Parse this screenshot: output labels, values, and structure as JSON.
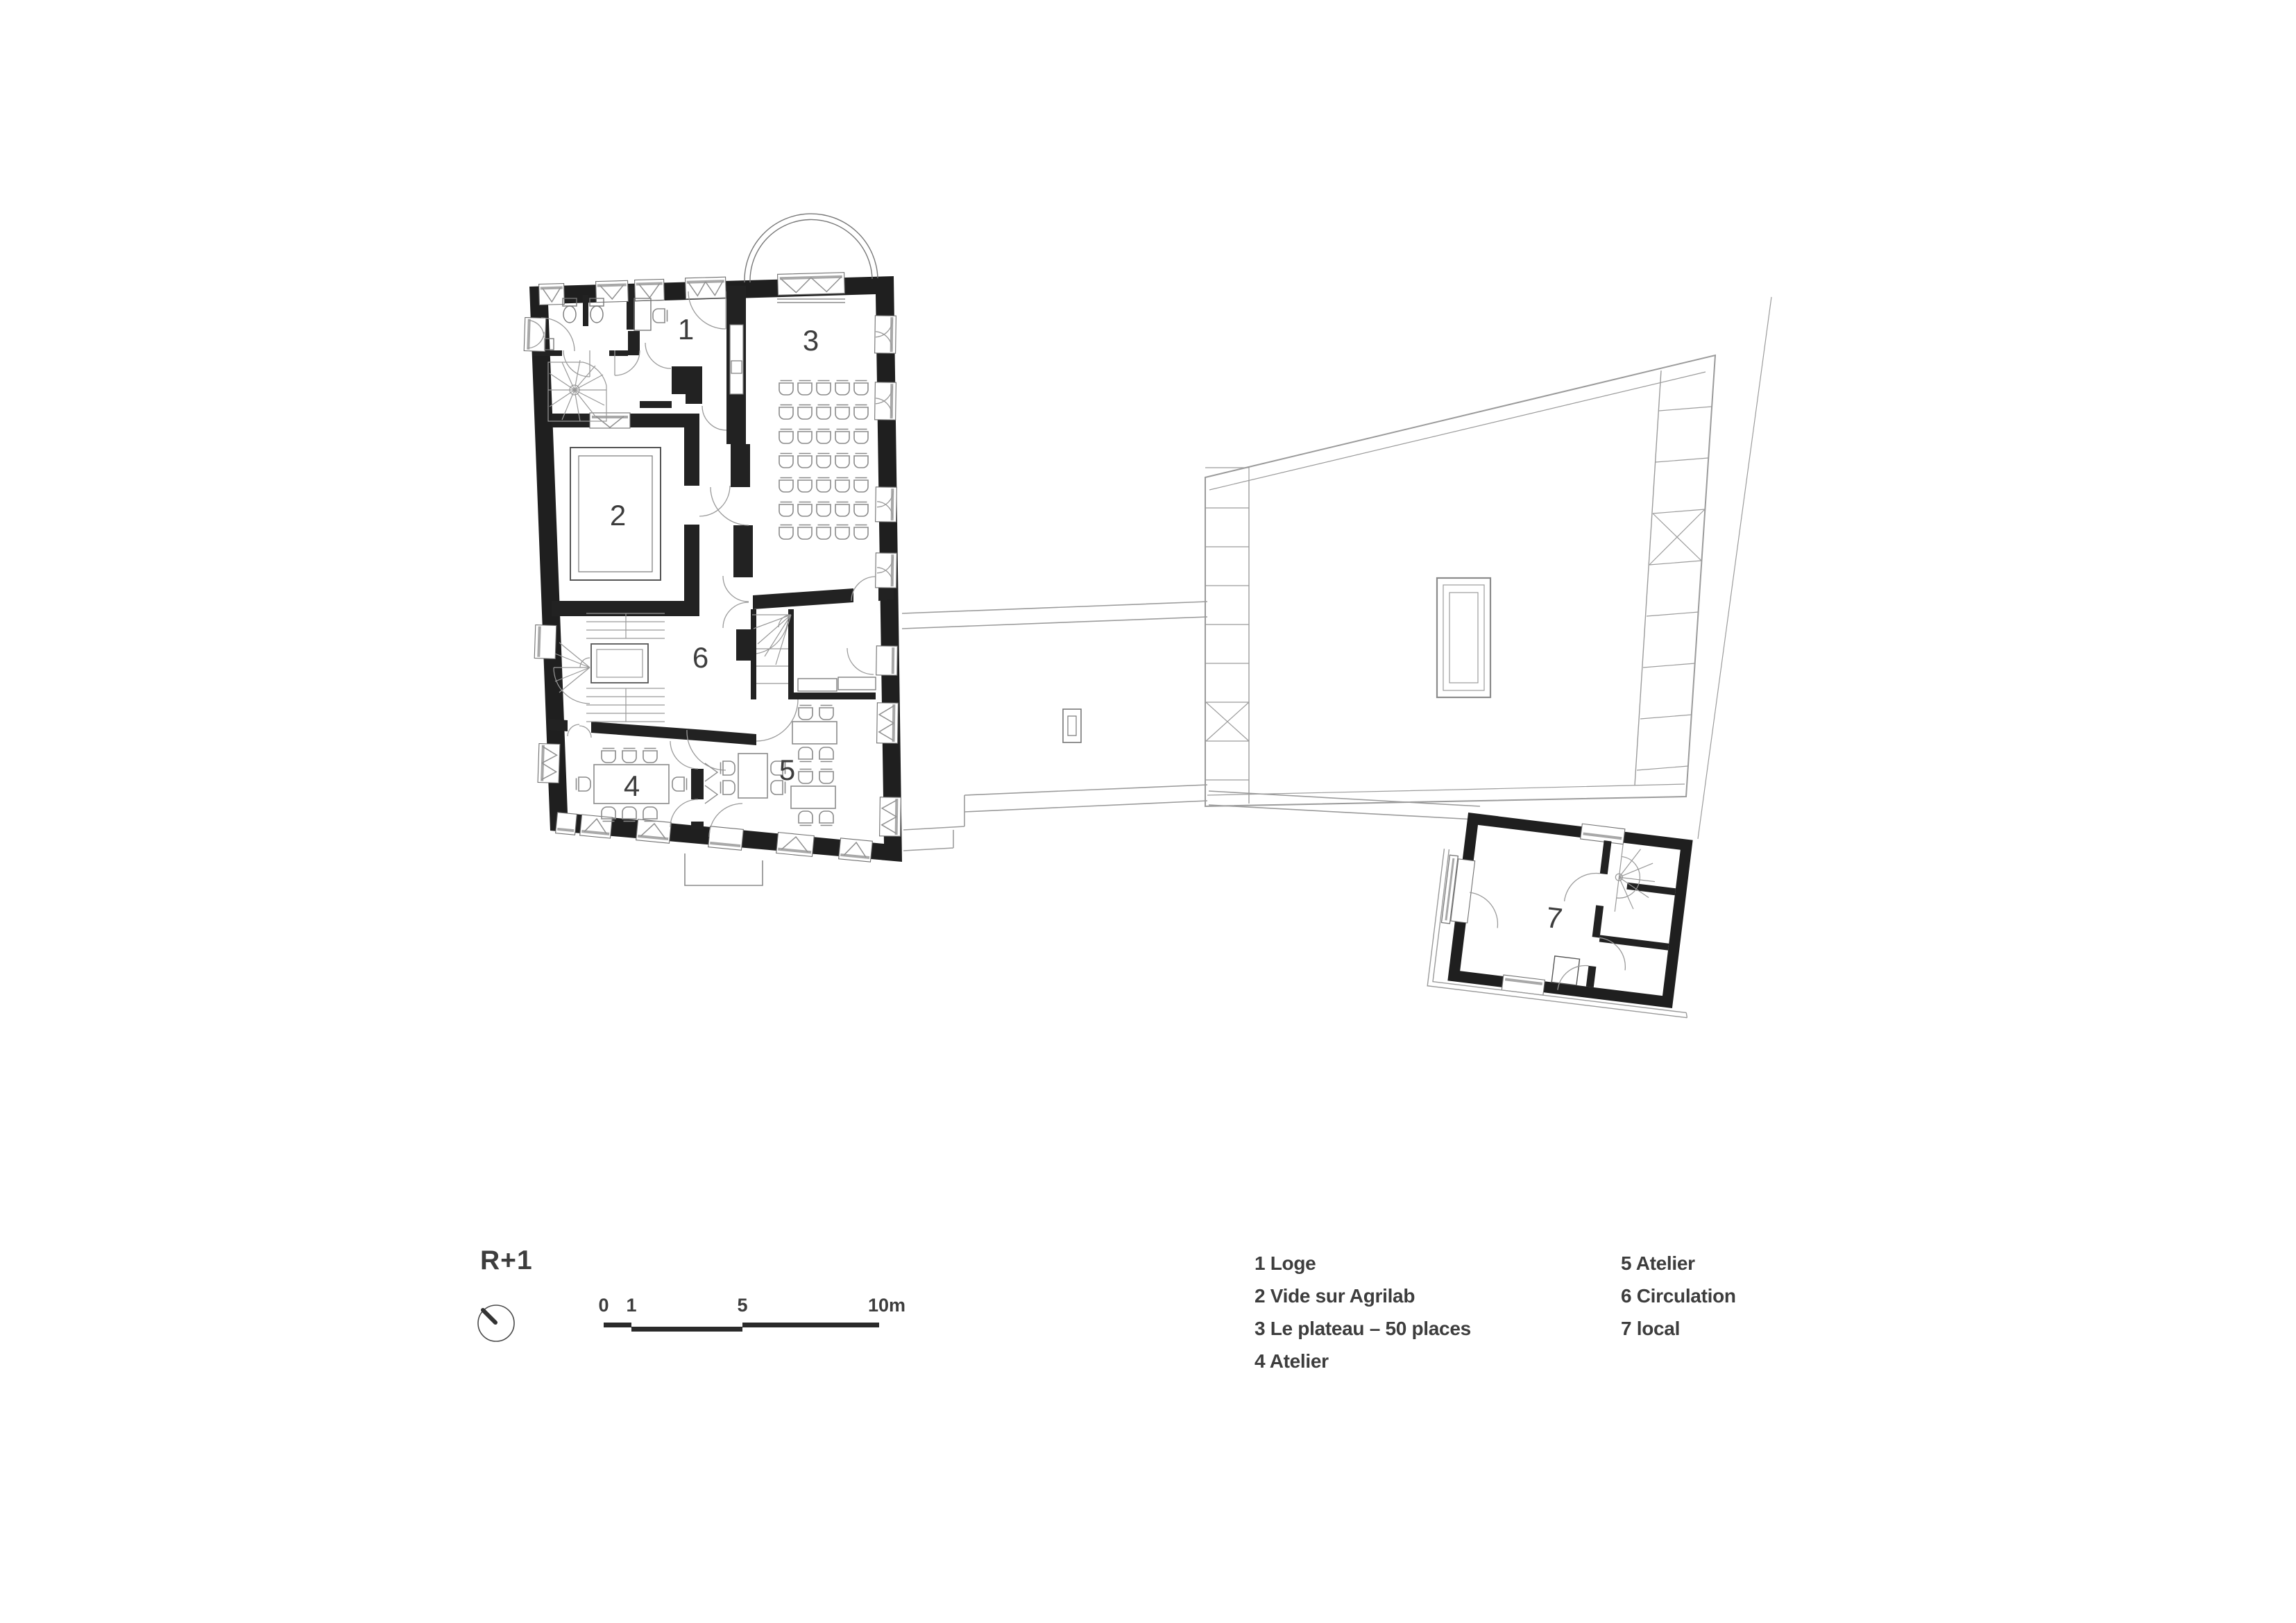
{
  "title": "R+1",
  "plan": {
    "room_labels": [
      "1",
      "2",
      "3",
      "4",
      "5",
      "6",
      "7"
    ]
  },
  "legend": {
    "col1": [
      "1 Loge",
      "2 Vide sur Agrilab",
      "3 Le plateau – 50 places",
      "4 Atelier"
    ],
    "col2": [
      "5 Atelier",
      "6 Circulation",
      "7 local"
    ]
  },
  "scalebar": {
    "ticks": [
      "0",
      "1",
      "5",
      "10m"
    ]
  },
  "colors": {
    "wall_ink": "#1f1f1f",
    "line_medium": "#8a8a8a",
    "line_light": "#9b9b9b",
    "text": "#3d3d3d"
  }
}
